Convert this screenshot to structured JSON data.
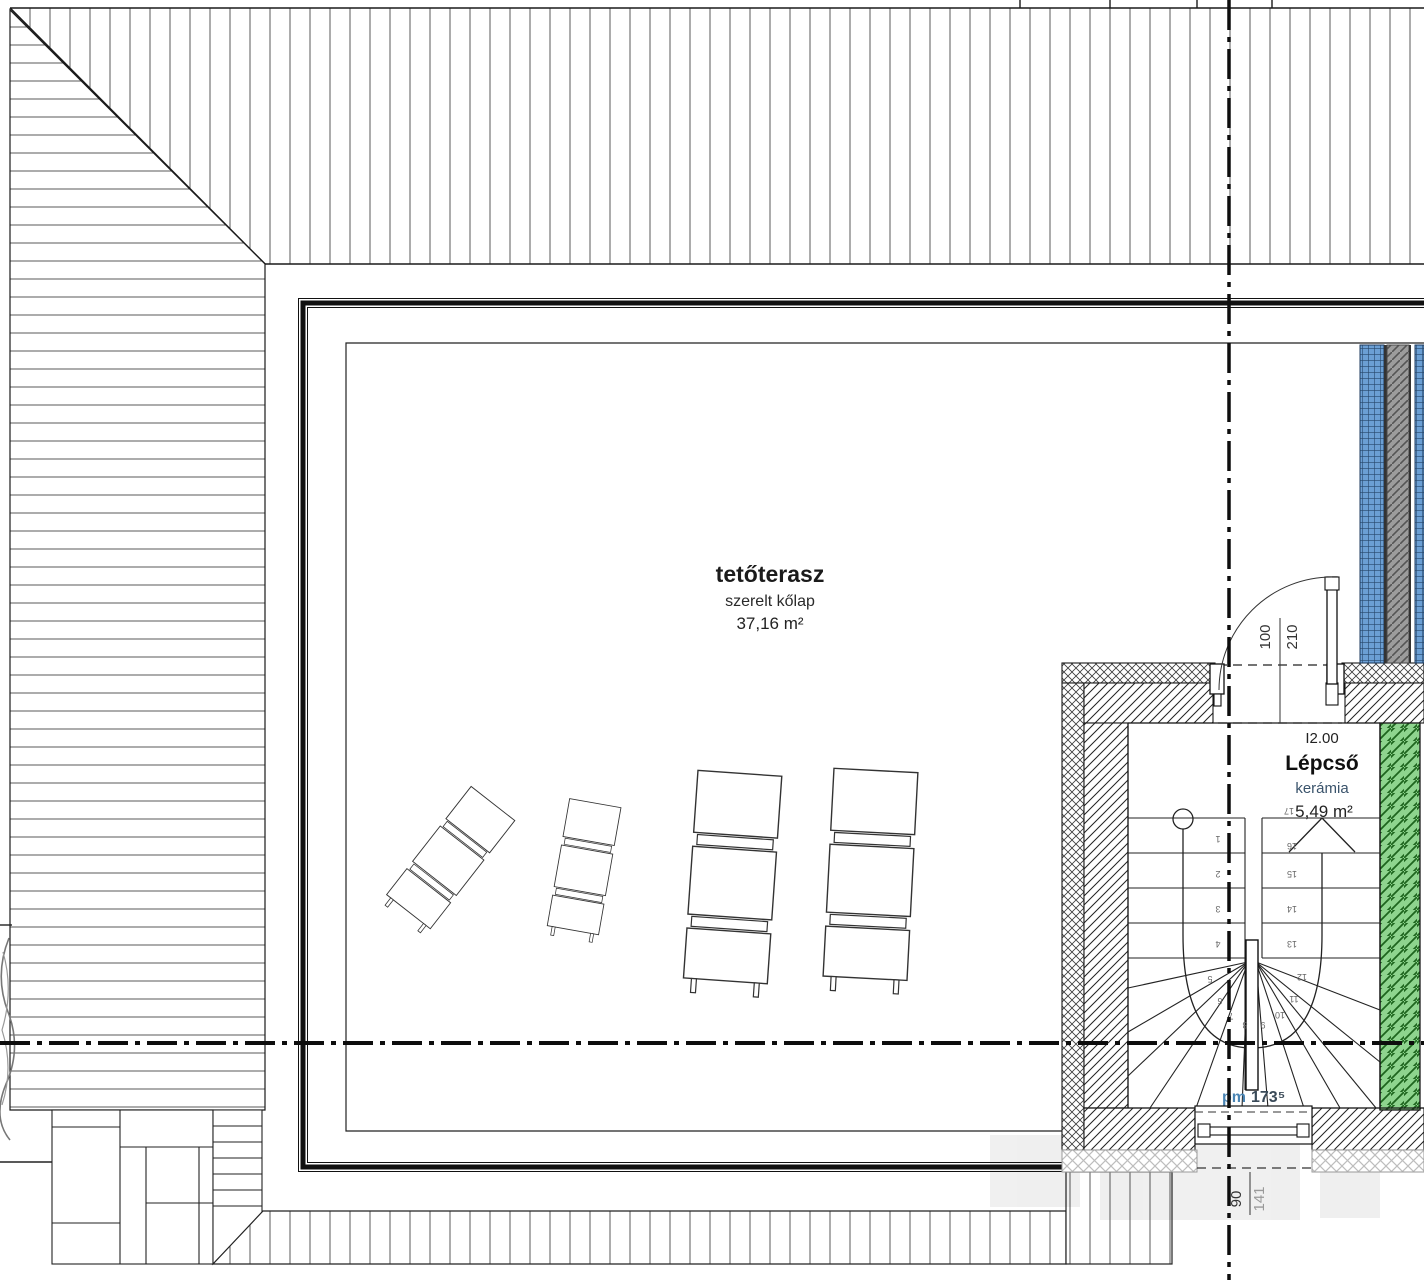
{
  "drawing": {
    "type": "floor-plan",
    "level": "roof terrace storey"
  },
  "terrace": {
    "name": "tetőterasz",
    "finish": "szerelt kőlap",
    "area": "37,16 m²"
  },
  "stairwell": {
    "room_number": "I2.00",
    "name": "Lépcső",
    "finish": "kerámia",
    "area": "5,49 m²",
    "level_prefix": "pm",
    "level_value": "173⁵",
    "step_numbers": [
      "1",
      "2",
      "3",
      "4",
      "5",
      "6",
      "7",
      "8",
      "9",
      "10",
      "11",
      "12",
      "13",
      "14",
      "15",
      "16",
      "17"
    ]
  },
  "dimensions": {
    "door": {
      "width": "100",
      "height": "210"
    },
    "window": {
      "width": "90",
      "height": "141"
    }
  },
  "colors": {
    "glass_block_blue": "#6b9fd4",
    "green_strip": "#8ed48e",
    "gray_strip": "#9c9c9c",
    "line": "#1a1a1a"
  }
}
